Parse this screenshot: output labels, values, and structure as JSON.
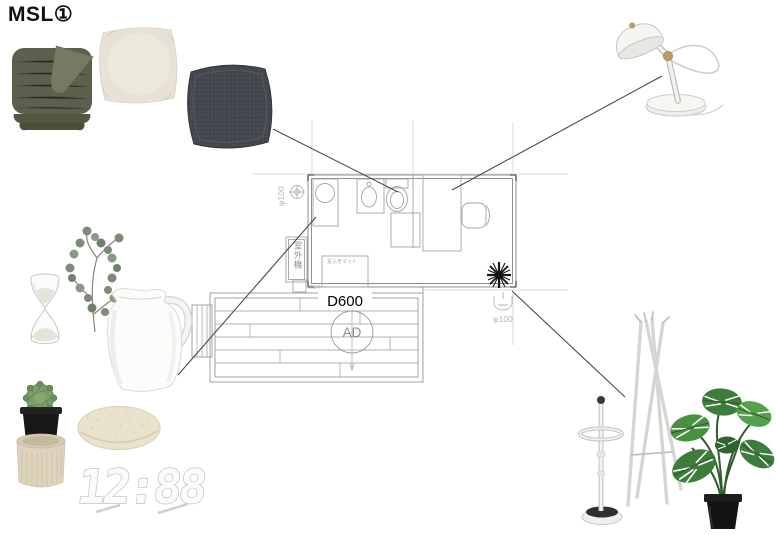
{
  "page": {
    "title": "MSL①"
  },
  "plan": {
    "labels": {
      "drain_left": "φ100",
      "drain_right": "φ100",
      "outdoor_unit": "室外機",
      "foot_mat": "足ふきマット",
      "step_note": "組立て",
      "deck_depth": "D600",
      "air_duct": "AD"
    }
  },
  "products": {
    "clock_display": "12:88",
    "items": [
      "throw-blanket-green",
      "cushion-beige",
      "cushion-dark-gray",
      "desk-lamp-white",
      "hourglass",
      "eucalyptus-branch",
      "pitcher-vase-white",
      "succulent-in-pot",
      "ribbed-pot-beige",
      "seat-pad-round",
      "digital-clock-white",
      "umbrella-stand-white",
      "coat-rack-white",
      "monstera-plant"
    ]
  },
  "colors": {
    "background": "#ffffff",
    "blanket_green": "#5c604d",
    "cushion_beige": "#e8e2d6",
    "cushion_dark": "#41464c",
    "plan_wall": "#8f8f8f",
    "plan_furniture": "#a3a3a3",
    "connector_line": "#4a4a4a",
    "leaf_green": "#3e7c3b",
    "pot_black": "#1b1b1b"
  }
}
